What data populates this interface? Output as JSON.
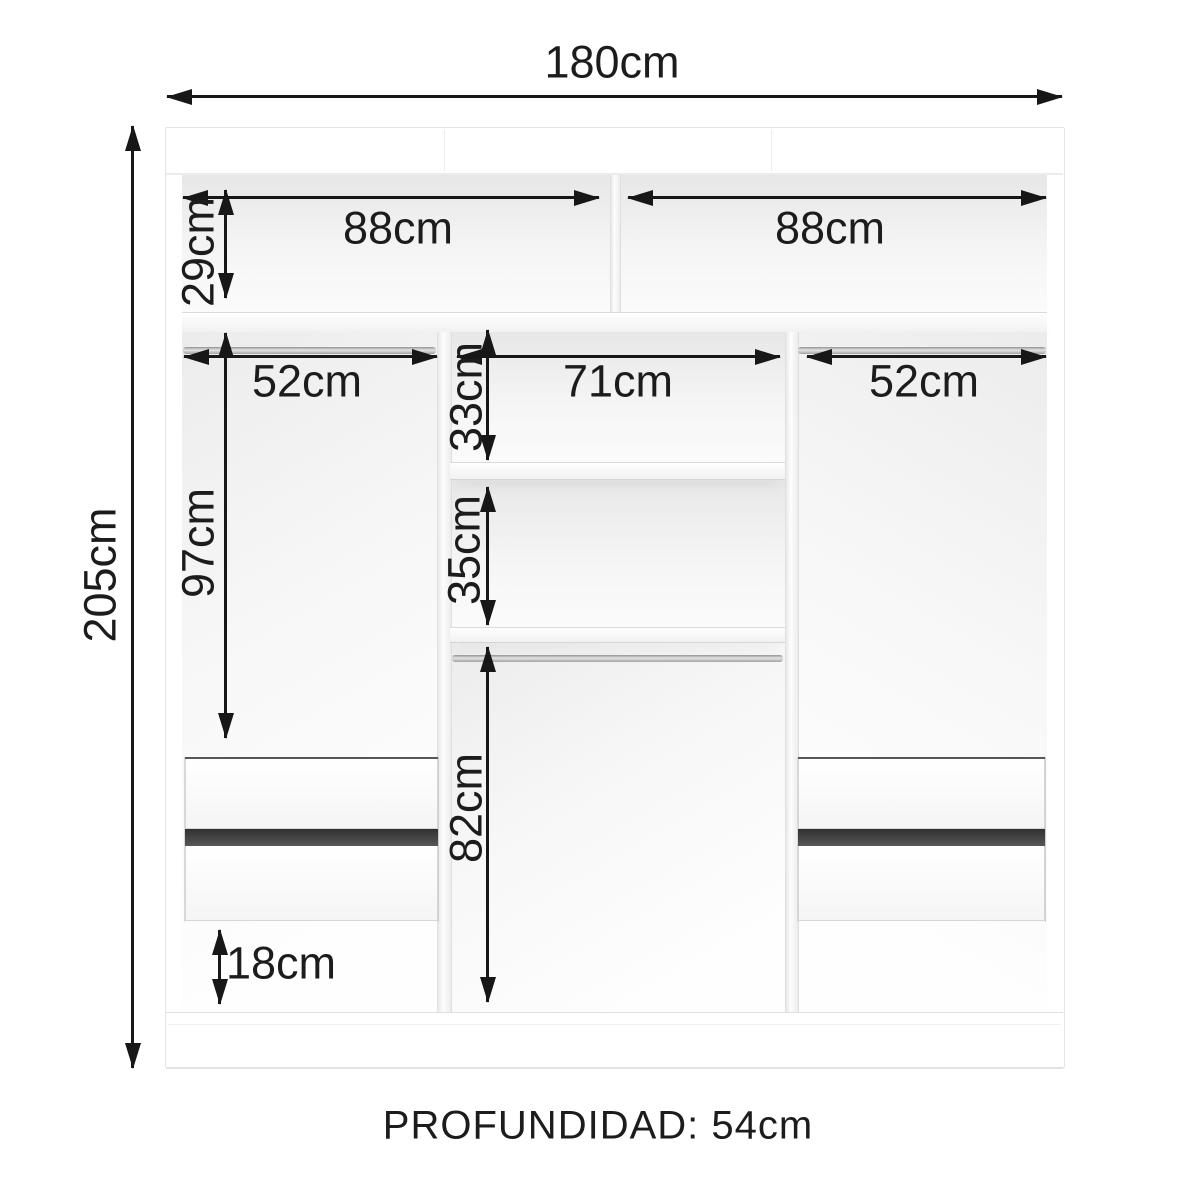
{
  "diagram": {
    "type": "wardrobe-internal-dimension-diagram",
    "depth_note": "PROFUNDIDAD: 54cm",
    "dims": {
      "total_width": "180cm",
      "total_height": "205cm",
      "top_left_width": "88cm",
      "top_right_width": "88cm",
      "top_section_height": "29cm",
      "left_rod_width": "52cm",
      "center_width": "71cm",
      "right_rod_width": "52cm",
      "center_upper_gap": "33cm",
      "center_middle_gap": "35cm",
      "left_hanging_height": "97cm",
      "center_lower_height": "82cm",
      "bottom_clearance": "18cm"
    },
    "colors": {
      "dimension_line": "#171717",
      "panel_edge": "#e4e4e4",
      "cavity_shadow": "#ececec",
      "drawer_gap": "#3a3a3a",
      "rod_metal": "#a3a3a3",
      "background": "#ffffff"
    }
  }
}
